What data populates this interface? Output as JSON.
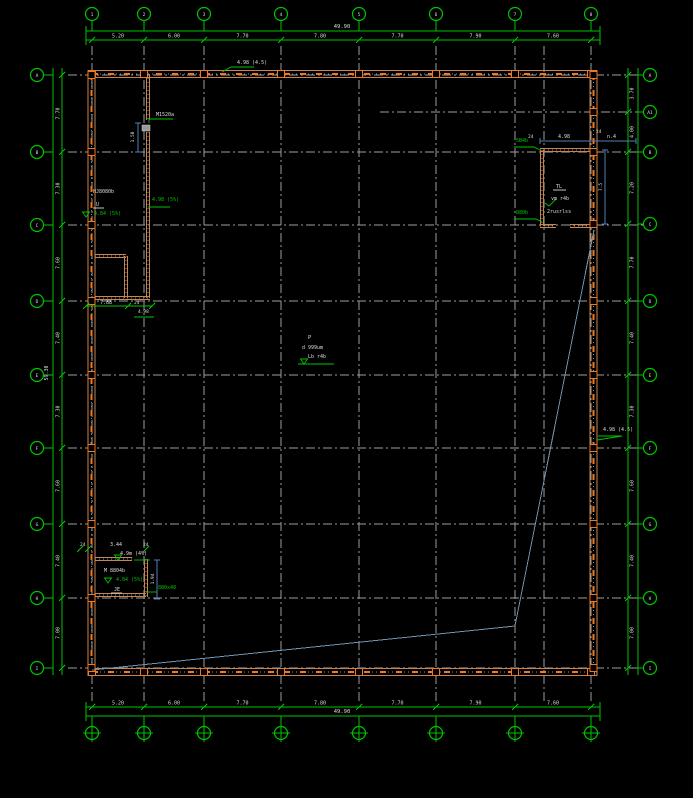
{
  "title": "cad-floor-plan",
  "canvas": {
    "w": 693,
    "h": 798,
    "bg": "#000000"
  },
  "colors": {
    "green": "#00c400",
    "grey": "#9e9e9e",
    "tan": "#c8854f",
    "orange": "#f07820",
    "steel": "#6f93b0",
    "blue": "#4f81bd",
    "white": "#dcdcdc"
  },
  "grid": {
    "top_xs": [
      92,
      144,
      204,
      281,
      359,
      436,
      515,
      591
    ],
    "top_labels": [
      "1",
      "2",
      "3",
      "4",
      "5",
      "6",
      "7",
      "8"
    ],
    "bottom_labels": [
      "1",
      "2",
      "3",
      "4",
      "5",
      "6",
      "7",
      "8"
    ],
    "left_ys": [
      75,
      152,
      225,
      301,
      375,
      448,
      524,
      598,
      668
    ],
    "left_labels": [
      "A",
      "B",
      "C",
      "D",
      "E",
      "F",
      "G",
      "H",
      "I"
    ],
    "right_ys": [
      75,
      112,
      152,
      224,
      301,
      375,
      448,
      524,
      598,
      668
    ],
    "right_labels": [
      "A",
      "A1",
      "B",
      "C",
      "D",
      "E",
      "F",
      "G",
      "H",
      "I"
    ],
    "extra_vline_x": 544,
    "short_hline": {
      "y": 112,
      "x1": 380,
      "x2": 645
    }
  },
  "dims": {
    "top": {
      "overall": "49.90",
      "segments": [
        "5.20",
        "6.00",
        "7.70",
        "7.80",
        "7.70",
        "7.90",
        "7.60"
      ]
    },
    "bottom": {
      "overall": "49.90",
      "segments": [
        "5.20",
        "6.00",
        "7.70",
        "7.80",
        "7.70",
        "7.90",
        "7.60"
      ]
    },
    "left": {
      "overall": "59.30",
      "segments": [
        "7.70",
        "7.30",
        "7.60",
        "7.40",
        "7.30",
        "7.60",
        "7.40",
        "7.00"
      ]
    },
    "right": {
      "segments": [
        "3.70",
        "4.00",
        "7.20",
        "7.70",
        "7.40",
        "7.30",
        "7.60",
        "7.40",
        "7.00"
      ]
    }
  },
  "walls": {
    "outer": {
      "x1": 88,
      "y1": 70,
      "x2": 597,
      "y2": 676
    },
    "rooms": [
      {
        "name": "top-left-room",
        "segs": [
          [
            148,
            74,
            148,
            120
          ],
          [
            148,
            132,
            148,
            298
          ],
          [
            95,
            298,
            150,
            298
          ]
        ]
      },
      {
        "name": "top-left-partition",
        "segs": [
          [
            95,
            256,
            126,
            256
          ],
          [
            126,
            256,
            126,
            298
          ]
        ]
      },
      {
        "name": "top-right-room",
        "segs": [
          [
            542,
            150,
            542,
            226
          ],
          [
            540,
            150,
            594,
            150
          ],
          [
            540,
            226,
            556,
            226
          ],
          [
            570,
            226,
            594,
            226
          ]
        ]
      },
      {
        "name": "bottom-left-room",
        "segs": [
          [
            95,
            559,
            132,
            559
          ],
          [
            146,
            559,
            146,
            597
          ],
          [
            95,
            595,
            146,
            595
          ]
        ]
      }
    ]
  },
  "diagonals": [
    [
      92,
      670,
      515,
      626
    ],
    [
      515,
      626,
      594,
      230
    ]
  ],
  "doors": [
    [
      142,
      125,
      8,
      6
    ]
  ],
  "blue_dims": [
    {
      "type": "v",
      "x": 138,
      "y1": 123,
      "y2": 152,
      "label": "1.50",
      "lx": 134,
      "ly": 137
    },
    {
      "type": "v",
      "x": 605,
      "y1": 150,
      "y2": 224,
      "label": "7.5",
      "lx": 602,
      "ly": 187
    },
    {
      "type": "v",
      "x": 157,
      "y1": 560,
      "y2": 599,
      "label": "1.94",
      "lx": 154,
      "ly": 579
    },
    {
      "type": "h",
      "y": 141,
      "x1": 540,
      "x2": 636,
      "label": "",
      "lx": 0,
      "ly": 0
    }
  ],
  "annotations": [
    {
      "x": 342,
      "y": 28,
      "text": "49.90",
      "color": "w",
      "anchor": "middle",
      "size": 5.5
    },
    {
      "x": 342,
      "y": 713,
      "text": "49.90",
      "color": "w",
      "anchor": "middle",
      "size": 5.5
    },
    {
      "x": 237,
      "y": 64,
      "text": "4.98 (4.5)",
      "color": "w",
      "size": 5
    },
    {
      "x": 156,
      "y": 116,
      "text": "M1520a",
      "color": "w",
      "size": 5
    },
    {
      "x": 93,
      "y": 193,
      "text": "HJ8080b",
      "color": "w",
      "size": 5
    },
    {
      "x": 96,
      "y": 206,
      "text": "U",
      "color": "w",
      "size": 5
    },
    {
      "x": 94,
      "y": 215,
      "text": "4.84 (5%)",
      "color": "g",
      "size": 5
    },
    {
      "x": 152,
      "y": 201,
      "text": "4.98 (5%)",
      "color": "g",
      "size": 5
    },
    {
      "x": 100,
      "y": 304,
      "text": "7.88",
      "color": "w",
      "size": 5
    },
    {
      "x": 134,
      "y": 304,
      "text": "24",
      "color": "w",
      "size": 4.5
    },
    {
      "x": 138,
      "y": 313,
      "text": "4.98",
      "color": "w",
      "size": 4.5
    },
    {
      "x": 528,
      "y": 138,
      "text": "24",
      "color": "w",
      "size": 4.5
    },
    {
      "x": 558,
      "y": 138,
      "text": "4.98",
      "color": "w",
      "size": 5
    },
    {
      "x": 607,
      "y": 138,
      "text": "n.4",
      "color": "w",
      "size": 5
    },
    {
      "x": 596,
      "y": 133,
      "text": "24",
      "color": "w",
      "size": 4.5
    },
    {
      "x": 516,
      "y": 142,
      "text": "5B4b",
      "color": "g",
      "size": 5
    },
    {
      "x": 516,
      "y": 214,
      "text": "880b",
      "color": "g",
      "size": 5
    },
    {
      "x": 556,
      "y": 188,
      "text": "TL",
      "color": "w",
      "size": 5
    },
    {
      "x": 551,
      "y": 200,
      "text": "vm r4b",
      "color": "w",
      "size": 5
    },
    {
      "x": 547,
      "y": 213,
      "text": "2rusrlss",
      "color": "w",
      "size": 5
    },
    {
      "x": 80,
      "y": 546,
      "text": "24",
      "color": "w",
      "size": 4.5
    },
    {
      "x": 110,
      "y": 546,
      "text": "3.44",
      "color": "w",
      "size": 5
    },
    {
      "x": 143,
      "y": 546,
      "text": "24",
      "color": "w",
      "size": 4.5
    },
    {
      "x": 120,
      "y": 555,
      "text": "4.9m (4%)",
      "color": "w",
      "size": 5
    },
    {
      "x": 158,
      "y": 589,
      "text": "880x48",
      "color": "g",
      "size": 5
    },
    {
      "x": 104,
      "y": 572,
      "text": "M 8804b",
      "color": "w",
      "size": 5
    },
    {
      "x": 116,
      "y": 581,
      "text": "4.84 (5%)",
      "color": "g",
      "size": 5
    },
    {
      "x": 114,
      "y": 591,
      "text": "JE",
      "color": "w",
      "size": 5
    },
    {
      "x": 308,
      "y": 339,
      "text": "P",
      "color": "w",
      "size": 5.5
    },
    {
      "x": 302,
      "y": 349,
      "text": "d 999um",
      "color": "w",
      "size": 5
    },
    {
      "x": 308,
      "y": 358,
      "text": "Lb r4b",
      "color": "w",
      "size": 5
    },
    {
      "x": 603,
      "y": 431,
      "text": "4.98 (4.5)",
      "color": "w",
      "size": 5
    }
  ],
  "rot_annotations": [
    {
      "x": 48,
      "y": 373,
      "text": "59.30",
      "color": "w",
      "size": 5
    }
  ],
  "leader_lines": [
    {
      "pts": [
        [
          222,
          72
        ],
        [
          231,
          67
        ],
        [
          254,
          67
        ]
      ],
      "color": "g"
    },
    {
      "pts": [
        [
          149,
          123
        ],
        [
          149,
          119
        ],
        [
          173,
          119
        ]
      ],
      "color": "g"
    },
    {
      "pts": [
        [
          148,
          207
        ],
        [
          170,
          207
        ]
      ],
      "color": "g"
    },
    {
      "pts": [
        [
          86,
          306
        ],
        [
          152,
          306
        ]
      ],
      "color": "g"
    },
    {
      "pts": [
        [
          134,
          317
        ],
        [
          154,
          317
        ]
      ],
      "color": "g"
    },
    {
      "pts": [
        [
          514,
          147
        ],
        [
          534,
          147
        ],
        [
          540,
          150
        ]
      ],
      "color": "g"
    },
    {
      "pts": [
        [
          514,
          219
        ],
        [
          536,
          219
        ],
        [
          542,
          222
        ]
      ],
      "color": "g"
    },
    {
      "pts": [
        [
          553,
          190
        ],
        [
          566,
          190
        ]
      ],
      "color": "w"
    },
    {
      "pts": [
        [
          93,
          208
        ],
        [
          104,
          208
        ]
      ],
      "color": "w"
    },
    {
      "pts": [
        [
          134,
          560
        ],
        [
          150,
          560
        ]
      ],
      "color": "g"
    },
    {
      "pts": [
        [
          146,
          592
        ],
        [
          157,
          592
        ]
      ],
      "color": "g"
    },
    {
      "pts": [
        [
          298,
          364
        ],
        [
          334,
          364
        ]
      ],
      "color": "g"
    },
    {
      "pts": [
        [
          598,
          436
        ],
        [
          622,
          436
        ],
        [
          597,
          440
        ]
      ],
      "color": "g"
    },
    {
      "pts": [
        [
          111,
          593
        ],
        [
          122,
          593
        ]
      ],
      "color": "w"
    },
    {
      "pts": [
        [
          545,
          203
        ],
        [
          549,
          206
        ],
        [
          556,
          199
        ]
      ],
      "color": "g"
    }
  ],
  "level_markers": [
    [
      86,
      217
    ],
    [
      108,
      583
    ],
    [
      304,
      364
    ],
    [
      118,
      560
    ]
  ],
  "dim_ticks_small": [
    [
      86,
      306
    ],
    [
      128,
      306
    ],
    [
      152,
      306
    ],
    [
      80,
      549
    ],
    [
      88,
      549
    ],
    [
      146,
      549
    ]
  ]
}
